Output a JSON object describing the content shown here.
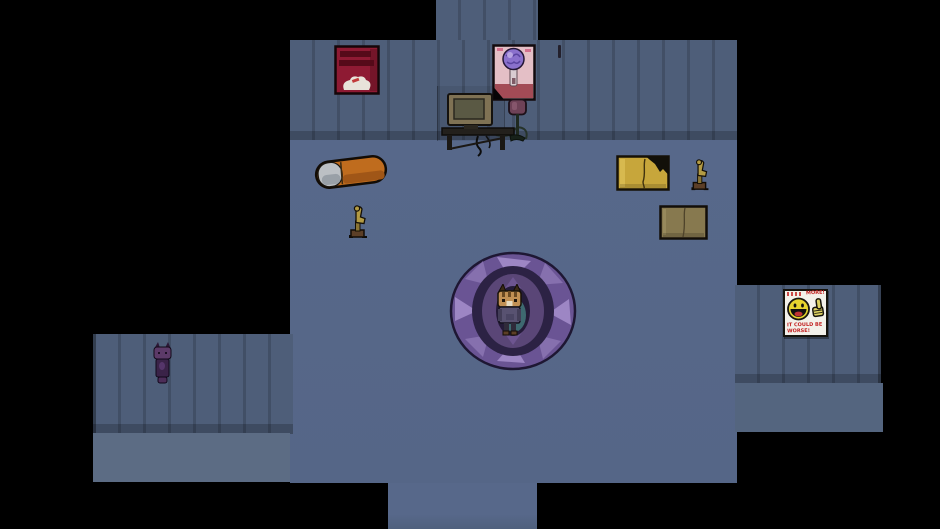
{
  "scene": {
    "background_color": "#000000",
    "room_colors": {
      "wall": "#4e5e79",
      "wall_stripe": "#43536c",
      "main_floor": "#57688a",
      "left_wing_floor": "#5c6c84",
      "right_wing_floor": "#54657f"
    },
    "entities": {
      "player": {
        "label": "cat-person standing on magic rug",
        "fur": "#c19054",
        "sweater": "#585271"
      },
      "npc_cat": {
        "label": "small purple cat",
        "body": "#3a2348",
        "head": "#5c3a68"
      },
      "rug": {
        "label": "purple circular patterned rug",
        "outer": "#6a5494",
        "triangles": "#9d86c4",
        "ring": "#5a4677",
        "center_teal": "#417277"
      },
      "bed": {
        "label": "orange bed with grey pillow",
        "blanket": "#bf6c1e",
        "pillow": "#bcc0c4"
      },
      "computer": {
        "label": "CRT computer on low desk",
        "bezel": "#7f7254",
        "screen": "#5a5944"
      },
      "lamp": {
        "label": "standing lamp with maroon shade",
        "shade": "#6e4257"
      },
      "chair_left": {
        "label": "small wooden chair",
        "wood": "#b39b44"
      },
      "chair_right": {
        "label": "small wooden chair",
        "wood": "#b39b44"
      },
      "table_yellow": {
        "label": "yellow table with torn corner",
        "top": "#c7a63b"
      },
      "table_brown": {
        "label": "brown table",
        "top": "#87794f"
      }
    }
  },
  "posters": {
    "red": {
      "label": "red poster with dark lettering and white figure",
      "bg": "#8e1a33"
    },
    "pink": {
      "label": "pink poster of figure with brain-cloud head",
      "bg": "#e4bfc6",
      "brain": "#8a70cc"
    },
    "smiley": {
      "label": "motivational smiley thumbs-up poster",
      "top_text": "MORE!",
      "bottom_text": "IT COULD BE WORSE!",
      "face_color": "#e7d52f",
      "text_color": "#c22020"
    }
  }
}
